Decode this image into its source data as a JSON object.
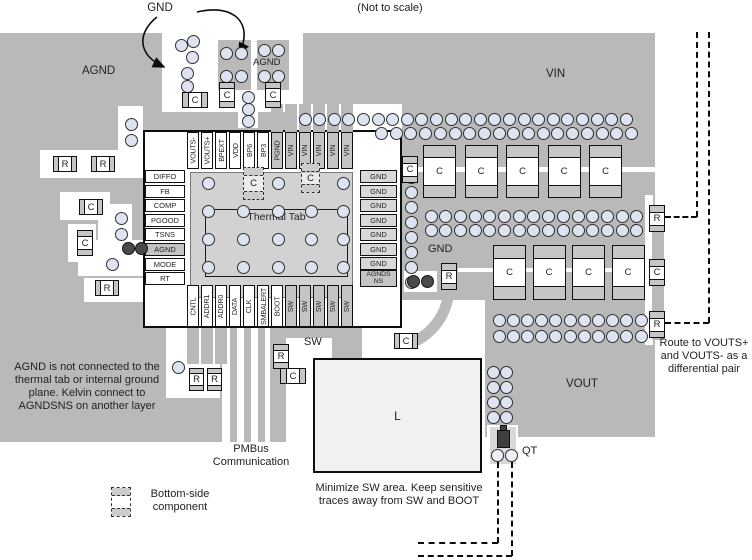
{
  "figure": {
    "scale_note": "(Not to scale)",
    "gnd_callout": "GND"
  },
  "regions": {
    "agnd_plane": "AGND",
    "agnd_pad": "AGND",
    "vin_plane": "VIN",
    "gnd_area": "GND",
    "vout_plane": "VOUT",
    "sw_area": "SW",
    "thermal_tab": "Thermal Tab"
  },
  "ic": {
    "top_pins": [
      "VOUTS-",
      "VOUTS+",
      "BPEXT",
      "VDD",
      "BP6",
      "BP3",
      "PGND",
      "VIN",
      "VIN",
      "VIN",
      "VIN",
      "VIN"
    ],
    "left_pins": [
      "DIFFO",
      "FB",
      "COMP",
      "PGOOD",
      "TSNS",
      "AGND",
      "MODE",
      "RT"
    ],
    "right_pins": [
      "GND",
      "GND",
      "GND",
      "GND",
      "GND",
      "GND",
      "GND",
      "AGNDSNS"
    ],
    "bottom_pins": [
      "CNTL",
      "ADDR1",
      "ADDR0",
      "DATA",
      "CLK",
      "SMBALERT",
      "BOOT",
      "SW",
      "SW",
      "SW",
      "SW",
      "SW"
    ]
  },
  "components": {
    "capacitor": "C",
    "resistor": "R",
    "inductor": "L",
    "transistor": "QT"
  },
  "notes": {
    "agnd": "AGND is not connected to the thermal tab or internal ground plane. Kelvin connect to AGNDSNS on another layer",
    "pmbus": "PMBus Communication",
    "sw": "Minimize SW area. Keep sensitive traces away from SW and BOOT",
    "route": "Route to VOUTS+ and VOUTS- as a differential pair",
    "legend": "Bottom-side component"
  },
  "colors": {
    "plane": "#b9b9b9",
    "thermal_tab": "#d2d2d2",
    "via_fill": "#dde3f0",
    "via_dark": "#4a4a4a",
    "component_end": "#c6c6c6",
    "pin_shade": "#c4c4c4",
    "inductor_fill": "#f1f1f1"
  }
}
